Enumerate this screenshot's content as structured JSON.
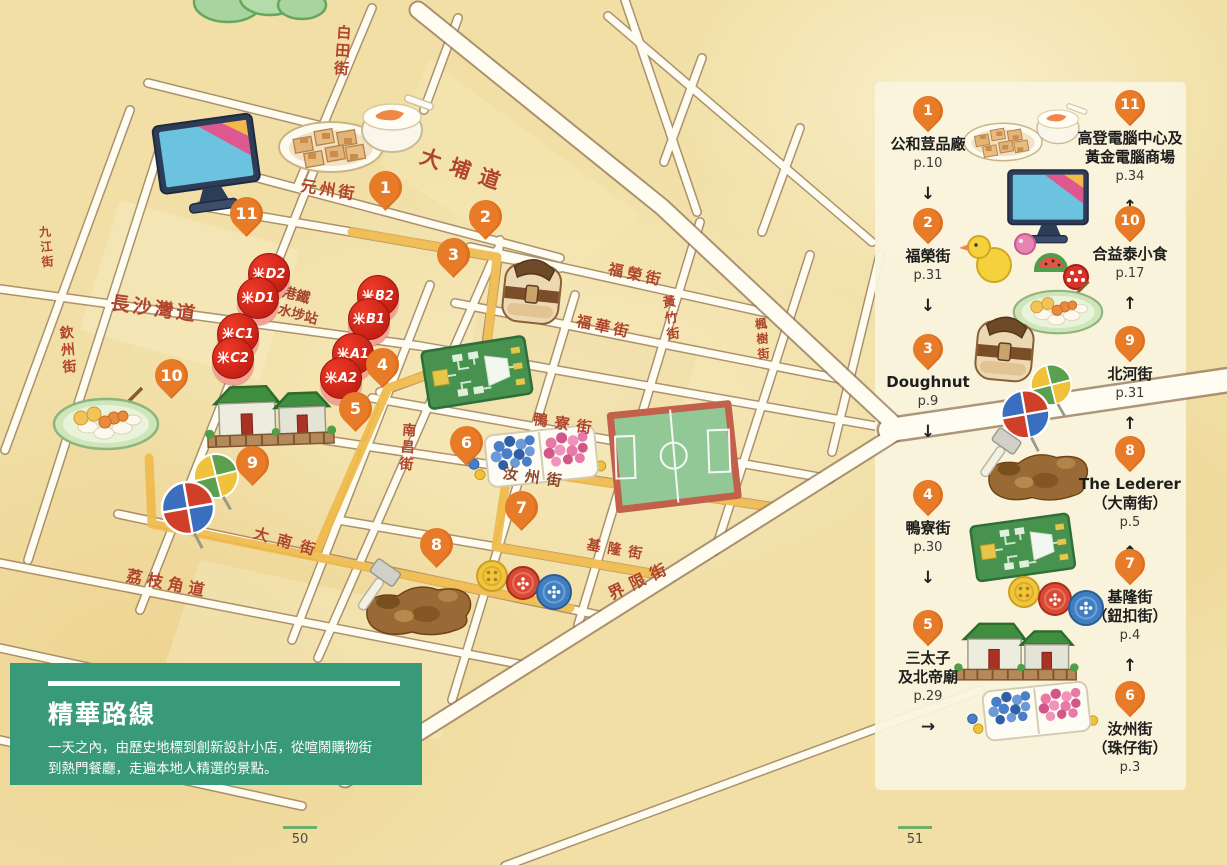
{
  "page": {
    "left_number": "50",
    "right_number": "51"
  },
  "info_box": {
    "title": "精華路線",
    "description": "一天之內，由歷史地標到創新設計小店，從喧鬧購物街到熱門餐廳，走遍本地人精選的景點。"
  },
  "map": {
    "mtr_logo": "米",
    "station_label_line1": "港鐵",
    "station_label_line2": "深水埗站",
    "mtr_exits": [
      {
        "label": "D2"
      },
      {
        "label": "D1"
      },
      {
        "label": "C1"
      },
      {
        "label": "C2"
      },
      {
        "label": "B2"
      },
      {
        "label": "B1"
      },
      {
        "label": "A1"
      },
      {
        "label": "A2"
      }
    ],
    "streets": [
      {
        "name": "白田街"
      },
      {
        "name": "大埔道"
      },
      {
        "name": "元州街"
      },
      {
        "name": "九江街"
      },
      {
        "name": "長沙灣道"
      },
      {
        "name": "欽州街"
      },
      {
        "name": "福榮街"
      },
      {
        "name": "福華街"
      },
      {
        "name": "黃竹街"
      },
      {
        "name": "楓樹街"
      },
      {
        "name": "鴨寮街"
      },
      {
        "name": "汝州街"
      },
      {
        "name": "南昌街"
      },
      {
        "name": "大南街"
      },
      {
        "name": "基隆街"
      },
      {
        "name": "界限街"
      },
      {
        "name": "荔枝角道"
      }
    ],
    "pins": [
      {
        "n": "1"
      },
      {
        "n": "2"
      },
      {
        "n": "3"
      },
      {
        "n": "4"
      },
      {
        "n": "5"
      },
      {
        "n": "6"
      },
      {
        "n": "7"
      },
      {
        "n": "8"
      },
      {
        "n": "9"
      },
      {
        "n": "10"
      },
      {
        "n": "11"
      }
    ]
  },
  "legend": {
    "left": [
      {
        "n": "1",
        "name": "公和荳品廠",
        "page": "p.10",
        "arrow": "↓"
      },
      {
        "n": "2",
        "name": "福榮街",
        "page": "p.31",
        "arrow": "↓"
      },
      {
        "n": "3",
        "name": "Doughnut",
        "page": "p.9",
        "arrow": "↓"
      },
      {
        "n": "4",
        "name": "鴨寮街",
        "page": "p.30",
        "arrow": "↓"
      },
      {
        "n": "5",
        "name": "三太子",
        "name2": "及北帝廟",
        "page": "p.29",
        "arrow": "→"
      }
    ],
    "right": [
      {
        "n": "11",
        "name": "高登電腦中心及",
        "name2": "黃金電腦商場",
        "page": "p.34",
        "arrow": "↑"
      },
      {
        "n": "10",
        "name": "合益泰小食",
        "page": "p.17",
        "arrow": "↑"
      },
      {
        "n": "9",
        "name": "北河街",
        "page": "p.31",
        "arrow": "↑"
      },
      {
        "n": "8",
        "name": "The Lederer",
        "name2": "（大南街）",
        "page": "p.5",
        "arrow": "↑"
      },
      {
        "n": "7",
        "name": "基隆街",
        "name2": "（鈕扣街）",
        "page": "p.4",
        "arrow": "↑"
      },
      {
        "n": "6",
        "name": "汝州街",
        "name2": "（珠仔街）",
        "page": "p.3"
      }
    ]
  },
  "colors": {
    "pin_orange": "#e87b28",
    "route_yellow": "#f0ba4c",
    "mtr_red": "#d8261c",
    "info_box_green": "#389a78",
    "street_text_red": "#b0452c",
    "paper": "#f1dfa6"
  }
}
